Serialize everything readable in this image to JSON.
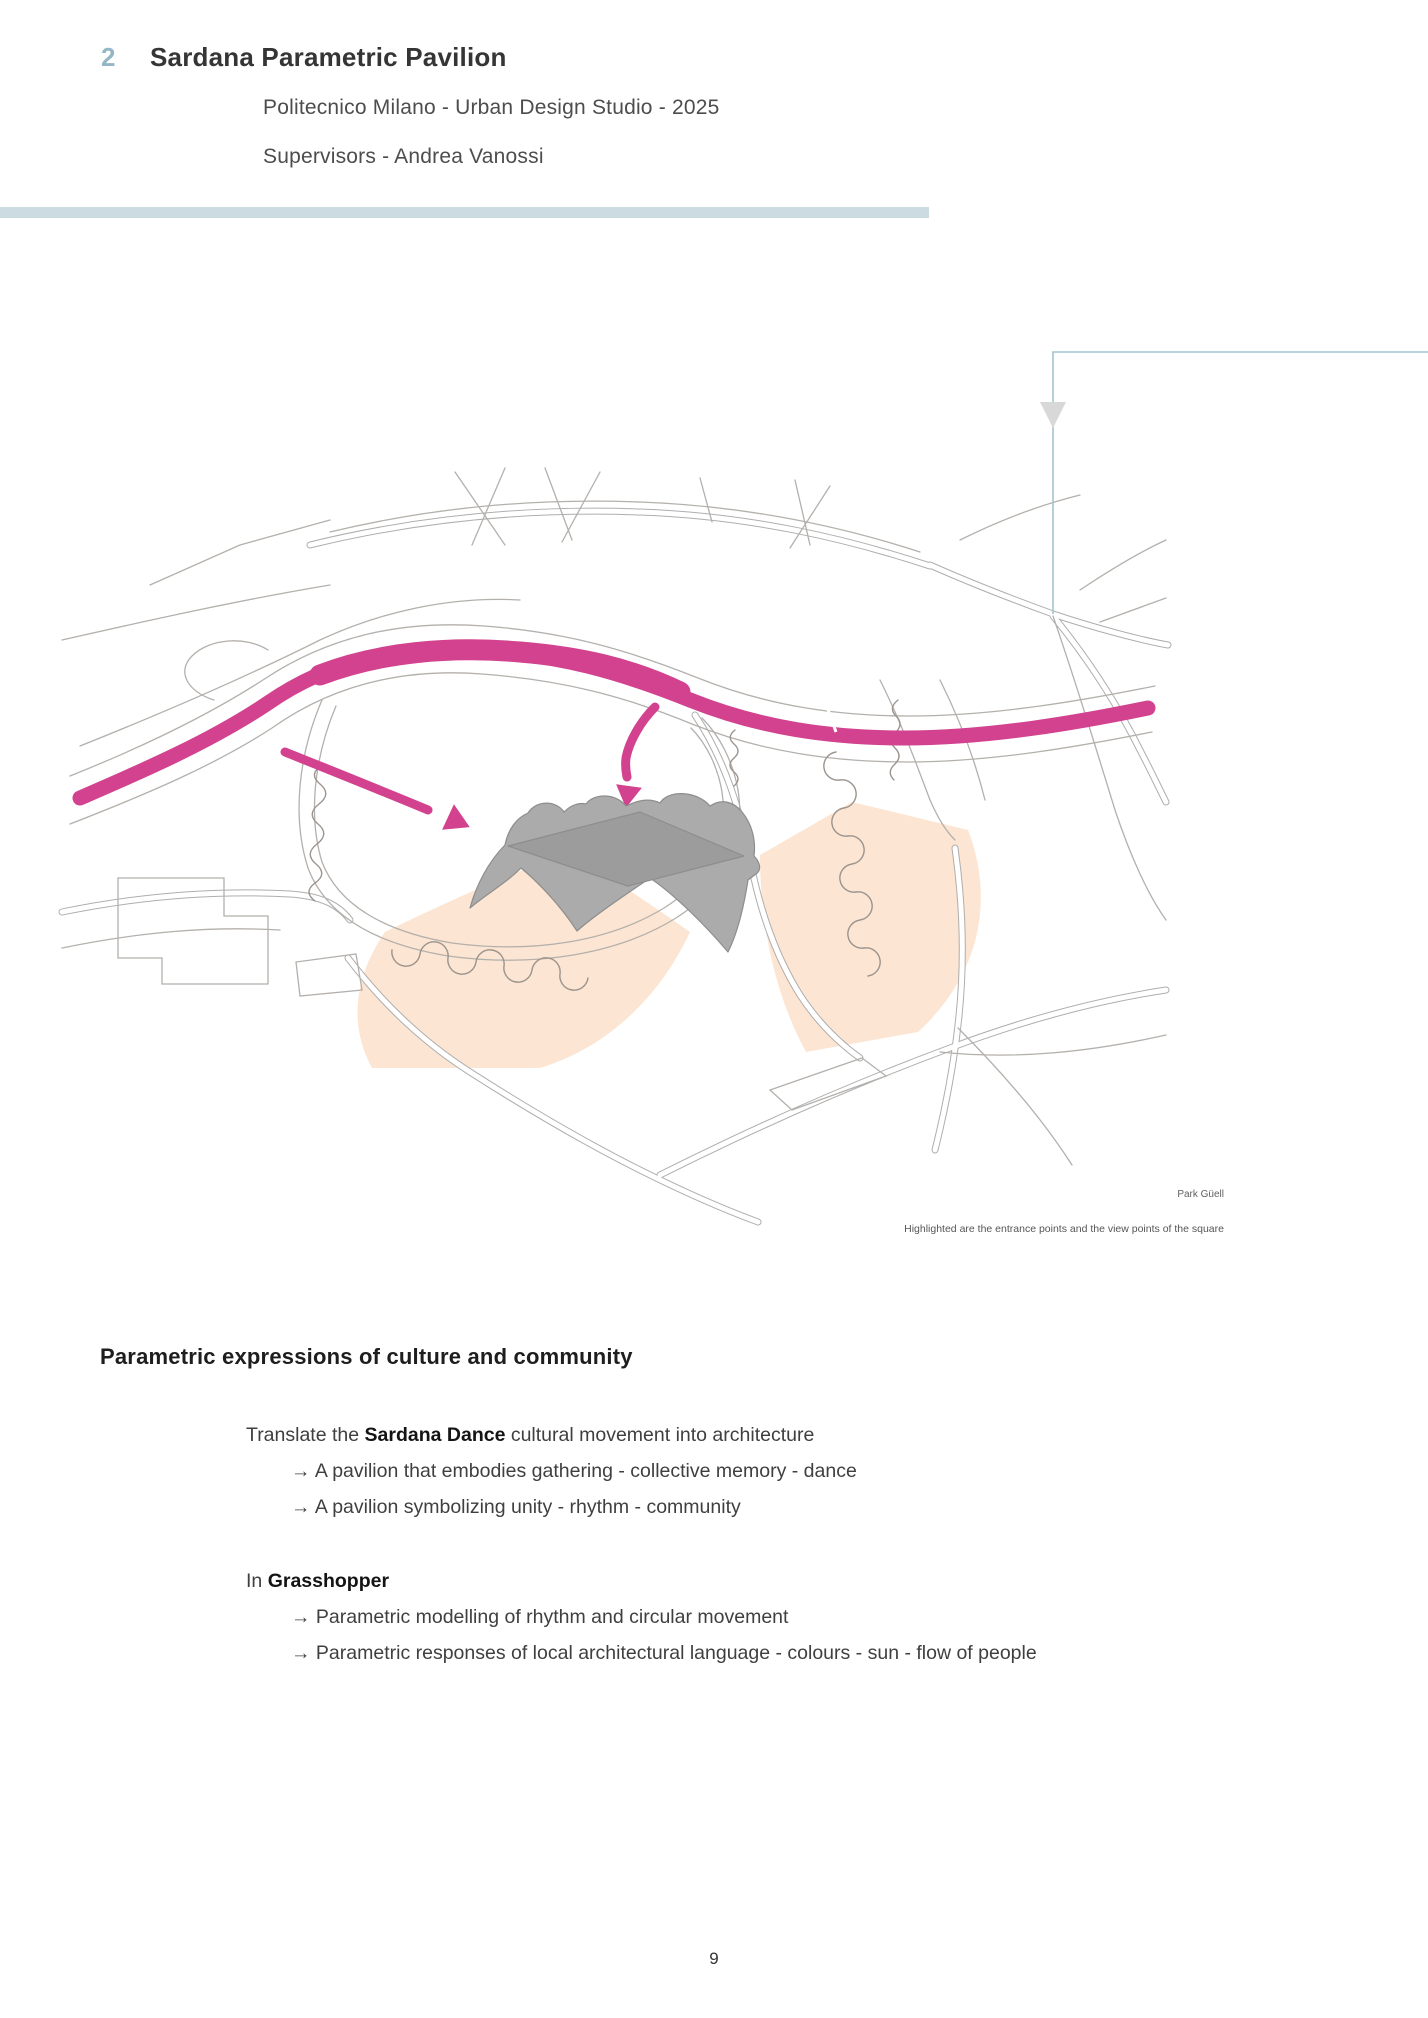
{
  "header": {
    "number": "2",
    "title": "Sardana Parametric Pavilion",
    "subtitle1": "Politecnico Milano - Urban Design Studio - 2025",
    "subtitle2": "Supervisors - Andrea Vanossi"
  },
  "figure": {
    "label": "Park Güell",
    "caption": "Highlighted are the entrance points and the view points of the square"
  },
  "content": {
    "heading": "Parametric expressions of culture and community",
    "block1": {
      "intro_pre": "Translate the ",
      "intro_bold": "Sardana Dance",
      "intro_post": " cultural movement into architecture",
      "bullets": [
        "→ A pavilion that embodies gathering - collective memory - dance",
        "→ A pavilion symbolizing unity - rhythm - community"
      ]
    },
    "block2": {
      "intro_pre": "In ",
      "intro_bold": "Grasshopper",
      "intro_post": "",
      "bullets": [
        "→ Parametric modelling of rhythm and circular movement",
        "→ Parametric responses of local architectural language - colours - sun - flow of people"
      ]
    }
  },
  "page_number": "9",
  "colors": {
    "accent_bar": "#ccdbe1",
    "chapter_number": "#93b7c5",
    "flow_ribbon": "#d2428e",
    "highlight_zone": "#fce5d2",
    "callout_line": "#a3c3d0",
    "callout_arrow": "#d8d8d8",
    "pavilion_fill": "#ababab",
    "road_line": "#b2aca8"
  }
}
